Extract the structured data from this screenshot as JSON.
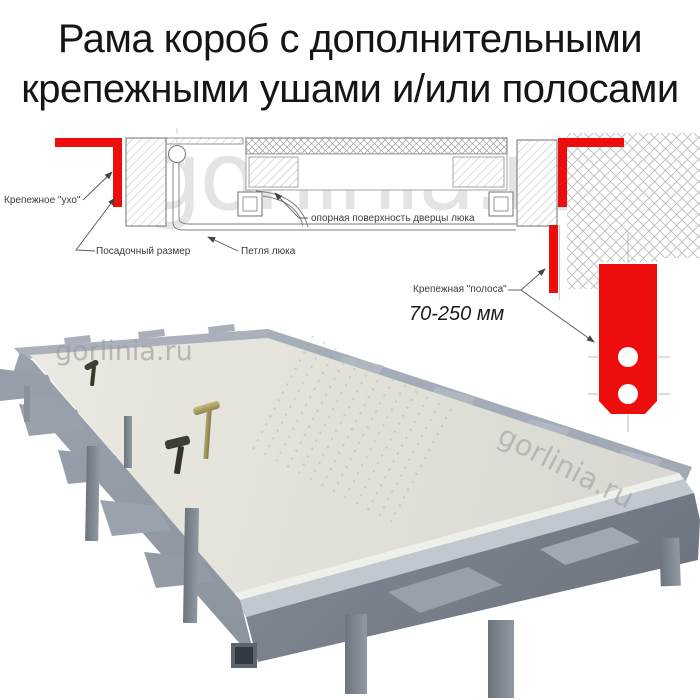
{
  "title": {
    "line1": "Рама короб с дополнительными",
    "line2": "крепежными ушами и/или полосами"
  },
  "watermark": "gorlinia.ru",
  "diagram": {
    "labels": {
      "ear": "Крепежное \"ухо\"",
      "seat_size": "Посадочный размер",
      "hinge": "Петля люка",
      "support_surface": "опорная поверхность дверцы люка",
      "strip": "Крепежная \"полоса\"",
      "strip_length_range": "70-250 мм"
    },
    "colors": {
      "accent_red": "#ee0d0d",
      "line": "#7d7d7d",
      "label_text": "#3b3b3b"
    }
  },
  "photo": {
    "colors": {
      "lid": "#e7e5dd",
      "frame": "#97a0ab",
      "frame_dark": "#747b86",
      "handle_gold": "#a79b60",
      "handle_dark": "#3c3a2f"
    }
  }
}
